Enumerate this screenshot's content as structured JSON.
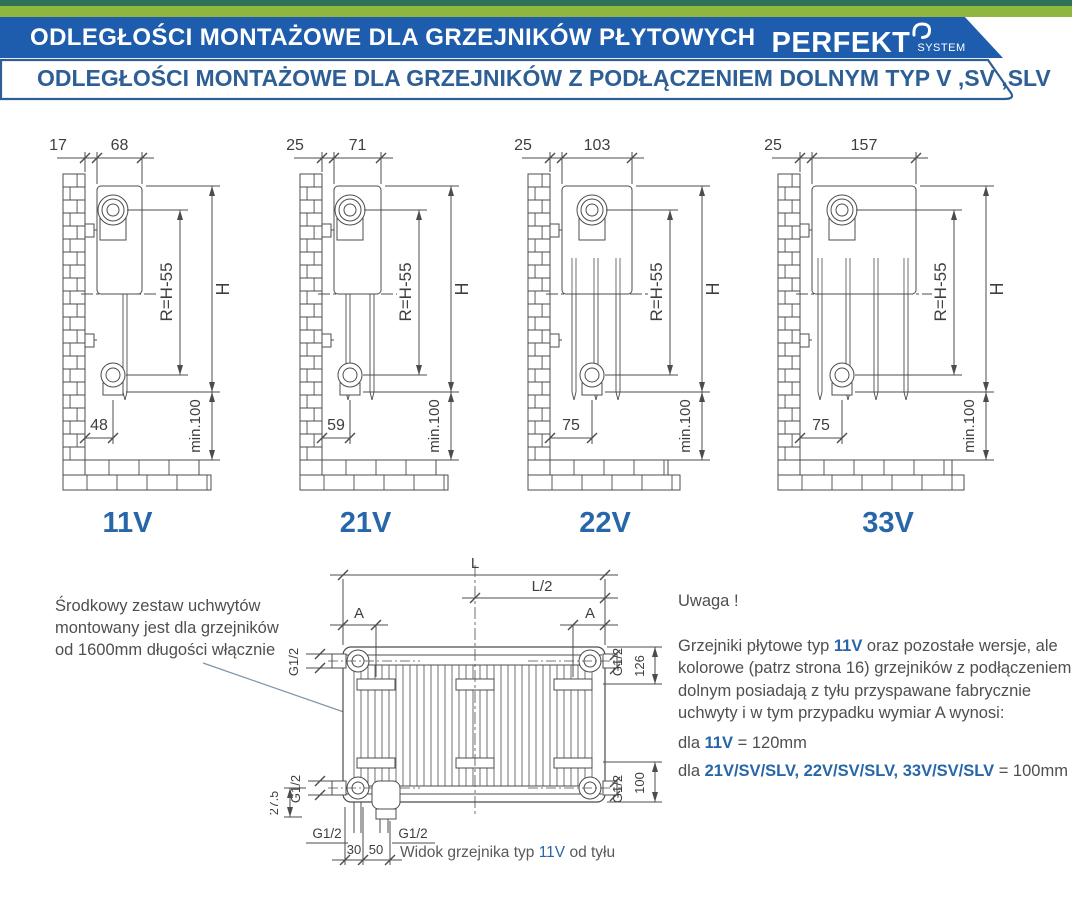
{
  "colors": {
    "strip_dark_green": "#2e7158",
    "strip_light_green": "#8fb63f",
    "banner_blue": "#1e5dad",
    "outline_blue": "#2d5f95",
    "accent_blue": "#2766a8",
    "line_gray": "#4c4c4c"
  },
  "header": {
    "title1": "ODLEGŁOŚCI  MONTAŻOWE  DLA GRZEJNIKÓW  PŁYTOWYCH",
    "logo_main": "PERFEKT",
    "logo_sub": "SYSTEM",
    "title2": "ODLEGŁOŚCI MONTAŻOWE DLA GRZEJNIKÓW Z PODŁĄCZENIEM DOLNYM TYP V ,SV ,SLV"
  },
  "side_diagrams": [
    {
      "type_label": "11V",
      "wall_gap": "17",
      "depth": "68",
      "bottom_offset": "48",
      "r_dim": "R=H-55",
      "h_dim": "H",
      "floor_clearance": "min.100"
    },
    {
      "type_label": "21V",
      "wall_gap": "25",
      "depth": "71",
      "bottom_offset": "59",
      "r_dim": "R=H-55",
      "h_dim": "H",
      "floor_clearance": "min.100"
    },
    {
      "type_label": "22V",
      "wall_gap": "25",
      "depth": "103",
      "bottom_offset": "75",
      "r_dim": "R=H-55",
      "h_dim": "H",
      "floor_clearance": "min.100"
    },
    {
      "type_label": "33V",
      "wall_gap": "25",
      "depth": "157",
      "bottom_offset": "75",
      "r_dim": "R=H-55",
      "h_dim": "H",
      "floor_clearance": "min.100"
    }
  ],
  "left_note": {
    "line1": "Środkowy zestaw uchwytów",
    "line2": "montowany jest dla grzejników",
    "line3": "od 1600mm długości włącznie"
  },
  "rear_diagram": {
    "length": "L",
    "half_length": "L/2",
    "bracket_dim": "A",
    "thread": "G1/2",
    "top_offset": "126",
    "bottom_offset": "100",
    "valve_offset": "27.5",
    "conn_30": "30",
    "conn_50": "50",
    "caption_pre": "Widok grzejnika typ ",
    "caption_type": "11V",
    "caption_post": " od tyłu"
  },
  "notes": {
    "title": "Uwaga !",
    "p1_pre": "Grzejniki płytowe typ ",
    "p1_type": "11V",
    "p1_post": " oraz pozostałe wersje, ale kolorowe (patrz strona 16) grzejników z podłączeniem dolnym posiadają z tyłu przyspawane fabrycznie uchwyty i w tym przypadku wymiar A wynosi:",
    "a1_pre": "dla ",
    "a1_types": "11V",
    "a1_val": " = 120mm",
    "a2_pre": "dla ",
    "a2_types": "21V/SV/SLV, 22V/SV/SLV, 33V/SV/SLV",
    "a2_val": " = 100mm"
  }
}
